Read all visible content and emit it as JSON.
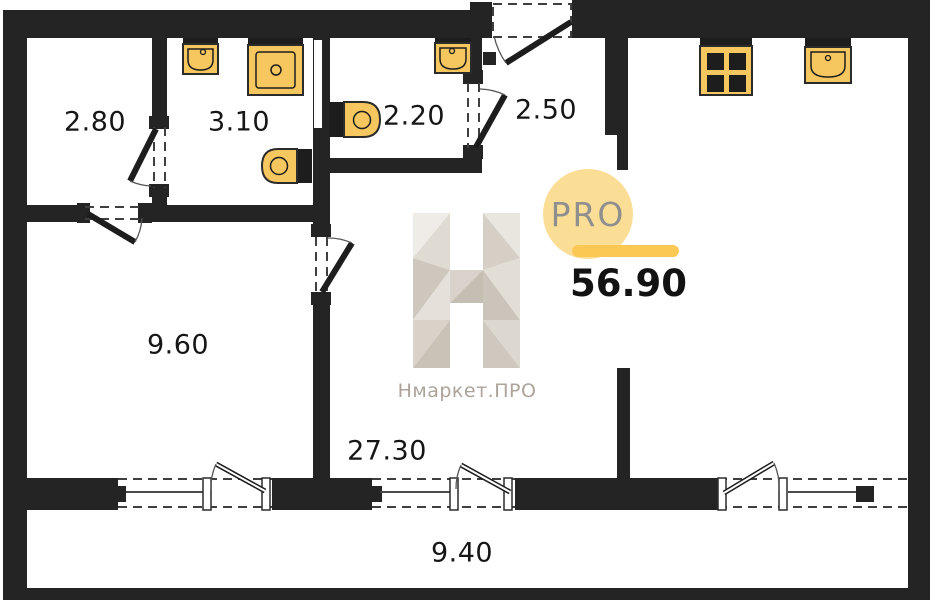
{
  "plan": {
    "room_areas": [
      {
        "id": "room-top-left",
        "area": "2.80"
      },
      {
        "id": "room-bath-1",
        "area": "3.10"
      },
      {
        "id": "room-bath-2",
        "area": "2.20"
      },
      {
        "id": "hallway",
        "area": "2.50"
      },
      {
        "id": "room-left",
        "area": "9.60"
      },
      {
        "id": "living-kitchen",
        "area": "27.30"
      },
      {
        "id": "balcony",
        "area": "9.40"
      }
    ],
    "total_area": "56.90",
    "fixtures": [
      "sink",
      "washing-machine",
      "toilet",
      "toilet",
      "sink",
      "stove",
      "kitchen-sink"
    ],
    "colors": {
      "wall": "#242424",
      "fixture_fill": "#F7C75F",
      "badge_circle": "#FBDE96",
      "badge_bar": "#FBC854",
      "logo_gray": "#D9D3CB",
      "watermark_text": "#ACA49B"
    }
  },
  "branding": {
    "badge_label": "PRO",
    "watermark": "Нмаркет.ПРО"
  }
}
